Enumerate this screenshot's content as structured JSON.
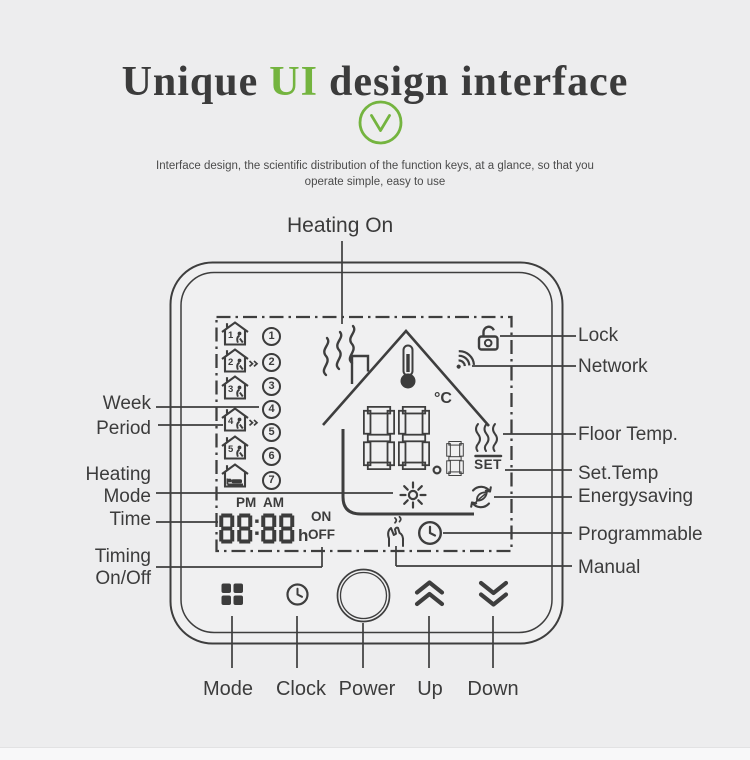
{
  "colors": {
    "accent_green": "#74b43f",
    "line_art": "#3e3e3e",
    "background": "#ededee",
    "title_text": "#3b3b3b"
  },
  "header": {
    "title_part1": "Unique",
    "title_highlight": "UI",
    "title_part2": "design interface",
    "check_icon": "v-check-circle-icon",
    "subtitle_line1": "Interface design, the scientific distribution of the function keys, at a glance, so that you",
    "subtitle_line2": "operate simple, easy to use"
  },
  "callouts": {
    "heating_on": "Heating On",
    "left": {
      "week": "Week",
      "period": "Period",
      "heating_mode_line1": "Heating",
      "heating_mode_line2": "Mode",
      "time": "Time",
      "timing_line1": "Timing",
      "timing_line2": "On/Off"
    },
    "right": [
      "Lock",
      "Network",
      "Floor Temp.",
      "Set.Temp",
      "Energysaving",
      "Programmable",
      "Manual"
    ],
    "bottom": [
      "Mode",
      "Clock",
      "Power",
      "Up",
      "Down"
    ]
  },
  "device": {
    "lcd": {
      "week_days": [
        "1",
        "2",
        "3",
        "4",
        "5",
        "6",
        "7"
      ],
      "periods": [
        {
          "number": "1",
          "icon": "house-person-icon"
        },
        {
          "number": "2",
          "icon": "house-person-leave-icon"
        },
        {
          "number": "3",
          "icon": "house-person-icon"
        },
        {
          "number": "4",
          "icon": "house-person-leave-icon"
        },
        {
          "number": "5",
          "icon": "house-person-icon"
        },
        {
          "number": "",
          "icon": "house-sleep-icon"
        }
      ],
      "pm": "PM",
      "am": "AM",
      "time_value": "88:88",
      "hour_unit": "h",
      "on": "ON",
      "off": "OFF",
      "temp_value": "88.8",
      "degree_unit": "°C",
      "set_label": "SET",
      "status_icons": [
        "heating-flame-icon",
        "house-outline-icon",
        "thermometer-icon",
        "lock-icon",
        "network-wifi-icon",
        "floor-temp-waves-icon",
        "sun-heating-mode-icon",
        "energysaving-icon",
        "manual-hand-icon",
        "programmable-clock-icon"
      ]
    },
    "buttons": [
      {
        "label": "mode",
        "icon": "mode-grid-icon"
      },
      {
        "label": "clock",
        "icon": "clock-icon"
      },
      {
        "label": "power",
        "icon": "power-circle-icon"
      },
      {
        "label": "up",
        "icon": "chevron-up-icon"
      },
      {
        "label": "down",
        "icon": "chevron-down-icon"
      }
    ]
  }
}
